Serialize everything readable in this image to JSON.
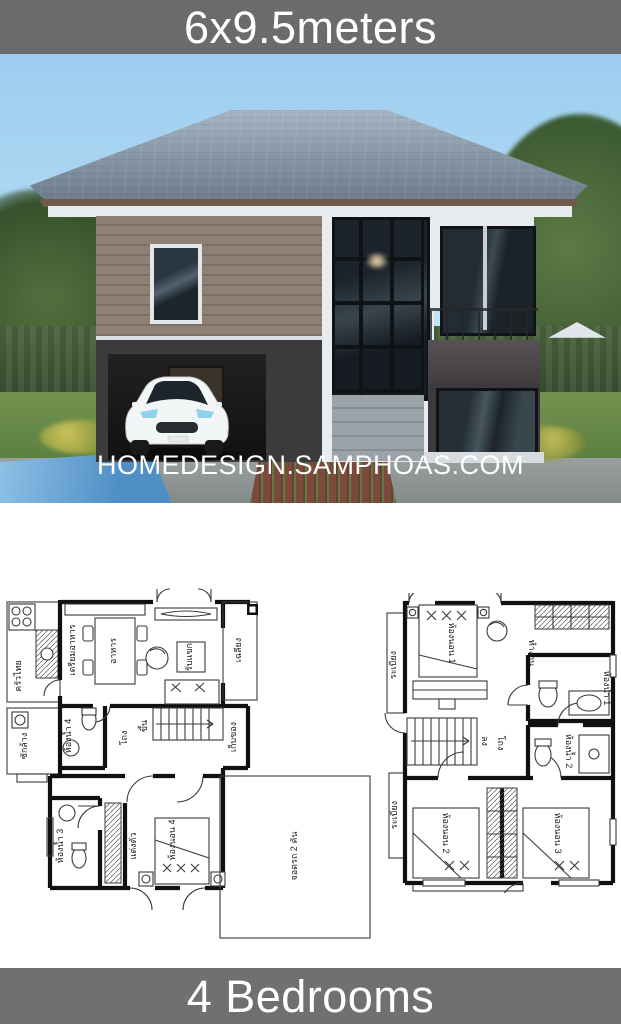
{
  "poster": {
    "top_banner": "6x9.5meters",
    "watermark": "HOMEDESIGN.SAMPHOAS.COM",
    "bottom_banner": "4 Bedrooms"
  },
  "colors": {
    "banner_gray": "#6b6b6d",
    "sky_blue": "#9ccdef",
    "roof_gray": "#8494a3",
    "siding_taupe": "#8e8072",
    "wall_dark": "#3d3a3d",
    "lawn_green": "#5b7f40",
    "pool_blue": "#4f8fc6",
    "paver_brown": "#7b4a3c",
    "plan_line": "#101010"
  },
  "first_floor": {
    "rooms": {
      "thai_kitchen": "ครัวไทย",
      "prep_kitchen": "เตรียมอาหาร",
      "dining": "อาหาร",
      "living": "รับแขก",
      "porch": "เฉลียง",
      "stairs_up": "ขึ้น",
      "hall": "โถง",
      "storage": "เก็บของ",
      "laundry": "ซักล้าง",
      "bathroom4": "ห้องน้ำ 4",
      "bathroom3": "ห้องน้ำ 3",
      "dressing": "แต่งตัว",
      "bedroom4": "ห้องนอน 4",
      "parking": "จอดรถ 2 คัน"
    }
  },
  "second_floor": {
    "rooms": {
      "balcony": "ระเบียง",
      "bedroom1": "ห้องนอน 1",
      "work": "ทำงาน",
      "bathroom1": "ห้องน้ำ 1",
      "hall": "โถง",
      "stairs_down": "ลง",
      "bathroom2": "ห้องน้ำ 2",
      "bedroom2": "ห้องนอน 2",
      "bedroom3": "ห้องนอน 3",
      "back_balcony": "ระเบียง"
    }
  }
}
